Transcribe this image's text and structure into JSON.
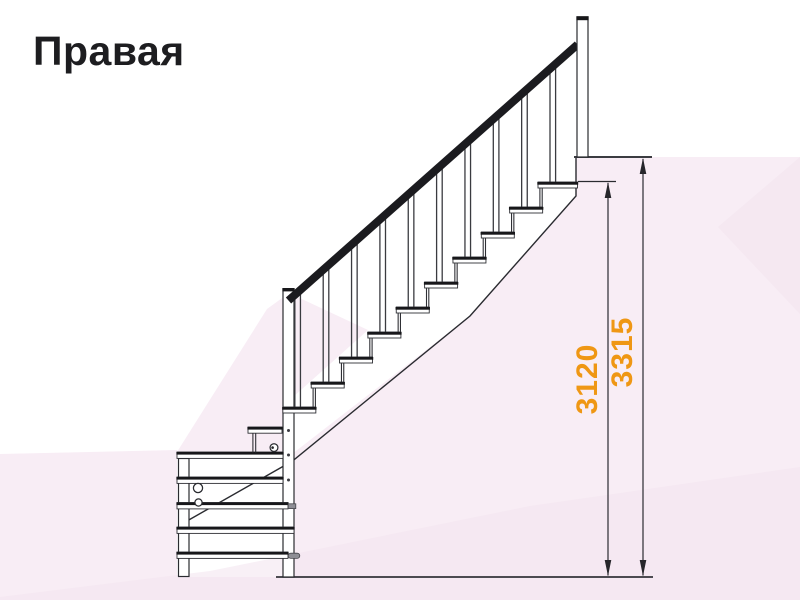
{
  "title": "Правая",
  "diagram": {
    "kind": "staircase-side-elevation",
    "dimensions": [
      {
        "id": "inner-height",
        "value": "3120"
      },
      {
        "id": "outer-height",
        "value": "3315"
      }
    ]
  },
  "colors": {
    "dimension_text": "#ef9714",
    "line_art": "#26262b",
    "background_tint": "#f8edf5"
  }
}
